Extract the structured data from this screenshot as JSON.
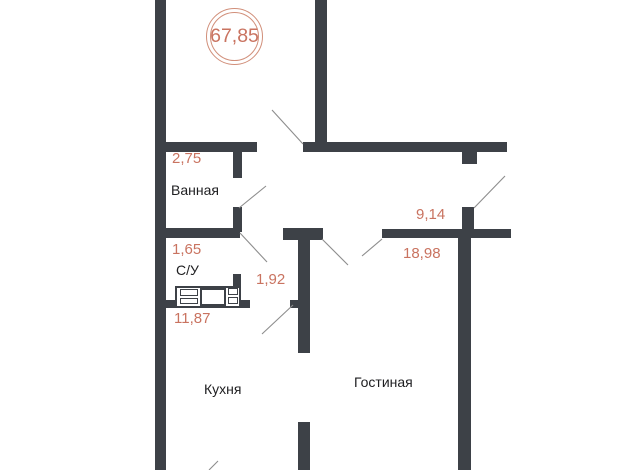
{
  "badge": {
    "total_area": "67,85"
  },
  "rooms": [
    {
      "name": "Ванная",
      "area": "2,75"
    },
    {
      "name": "С/У",
      "area": "1,65"
    },
    {
      "name": "",
      "area": "1,92"
    },
    {
      "name": "Кухня",
      "area": "11,87"
    },
    {
      "name": "",
      "area": "9,14"
    },
    {
      "name": "Гостиная",
      "area": "18,98"
    }
  ],
  "palette": {
    "wall": "#3d4147",
    "area_text": "#c97360",
    "room_text": "#1e1e20",
    "door_line": "#8d8d8d",
    "badge_ring": "#d18f7a",
    "background": "#ffffff"
  }
}
